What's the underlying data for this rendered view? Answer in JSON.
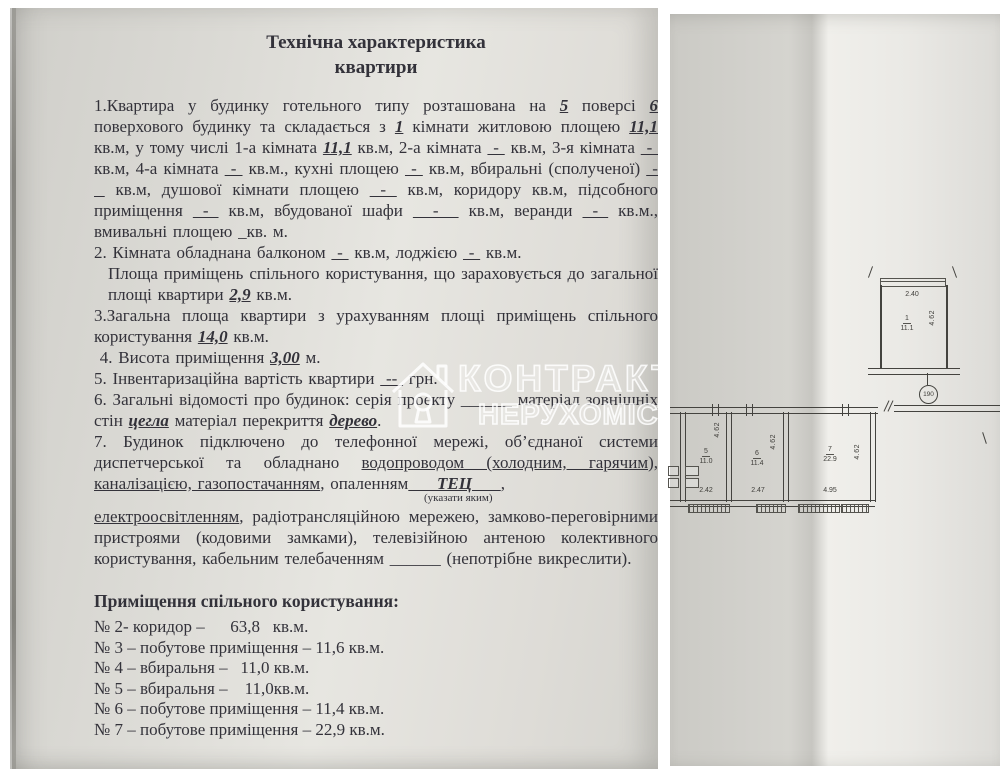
{
  "watermark": {
    "line1": "КОНТРАКТ",
    "line2": "НЕРУХОМІСТЬ",
    "icon": "house-keyhole-icon"
  },
  "document": {
    "title_line1": "Технічна характеристика",
    "title_line2": "квартири",
    "paragraphs": [
      {
        "name": "paragraph-1",
        "segments": [
          {
            "t": "1.Квартира у будинку готельного  типу розташована на "
          },
          {
            "t": "5",
            "s": "fill"
          },
          {
            "t": " поверсі "
          },
          {
            "t": "6",
            "s": "fill"
          },
          {
            "t": " поверхового будинку та складається з "
          },
          {
            "t": "1",
            "s": "fill"
          },
          {
            "t": " кімнати житловою площею "
          },
          {
            "t": "11,1",
            "s": "fill"
          },
          {
            "t": " кв.м, у тому числі 1-а кімната "
          },
          {
            "t": "11,1",
            "s": "fill"
          },
          {
            "t": " кв.м,  2-а кімната "
          },
          {
            "t": " - ",
            "s": "blank"
          },
          {
            "t": " кв.м,  3-я кімната "
          },
          {
            "t": " - ",
            "s": "blank"
          },
          {
            "t": " кв.м, 4-а кімната "
          },
          {
            "t": " - ",
            "s": "blank"
          },
          {
            "t": " кв.м., кухні площею "
          },
          {
            "t": " - ",
            "s": "blank"
          },
          {
            "t": " кв.м, вбиральні (сполученої)  "
          },
          {
            "t": " - ",
            "s": "blank"
          },
          {
            "t": " кв.м, душової кімнати площею "
          },
          {
            "t": " - ",
            "s": "blank"
          },
          {
            "t": " кв.м, коридору кв.м, підсобного приміщення "
          },
          {
            "t": " - ",
            "s": "blank"
          },
          {
            "t": " кв.м, вбудованої шафи "
          },
          {
            "t": "  -  ",
            "s": "blank"
          },
          {
            "t": " кв.м, веранди "
          },
          {
            "t": " - ",
            "s": "blank"
          },
          {
            "t": " кв.м., вмивальні площею _кв. м."
          }
        ]
      },
      {
        "name": "paragraph-2",
        "segments": [
          {
            "t": "2. Кімната обладнана балконом "
          },
          {
            "t": " - ",
            "s": "blank"
          },
          {
            "t": " кв.м, лоджією "
          },
          {
            "t": " - ",
            "s": "blank"
          },
          {
            "t": " кв.м."
          }
        ]
      },
      {
        "name": "paragraph-2b",
        "class": "indent",
        "segments": [
          {
            "t": "Площа приміщень спільного користування, що зараховується до загальної площі квартири "
          },
          {
            "t": "2,9",
            "s": "fill"
          },
          {
            "t": " кв.м."
          }
        ]
      },
      {
        "name": "paragraph-3",
        "segments": [
          {
            "t": "3.Загальна площа квартири з урахуванням площі приміщень спільного користування "
          },
          {
            "t": "14,0",
            "s": "fill"
          },
          {
            "t": " кв.м."
          }
        ]
      },
      {
        "name": "paragraph-4",
        "segments": [
          {
            "t": " 4. Висота приміщення "
          },
          {
            "t": "3,00",
            "s": "fill"
          },
          {
            "t": " м."
          }
        ]
      },
      {
        "name": "paragraph-5",
        "segments": [
          {
            "t": "5. Інвентаризаційна вартість квартири "
          },
          {
            "t": " -- ",
            "s": "blank"
          },
          {
            "t": " грн."
          }
        ]
      },
      {
        "name": "paragraph-6",
        "segments": [
          {
            "t": "6. Загальні відомості про будинок: серія проекту ______ матеріал зовнішніх стін "
          },
          {
            "t": "цегла",
            "s": "fill"
          },
          {
            "t": " матеріал перекриття "
          },
          {
            "t": "дерево",
            "s": "fill"
          },
          {
            "t": "."
          }
        ]
      },
      {
        "name": "paragraph-7",
        "segments": [
          {
            "t": "7. Будинок підключено до телефонної мережі, об’єднаної системи диспетчерської та обладнано "
          },
          {
            "t": "водопроводом (холодним, гарячим), каналізацією, газопостачанням",
            "s": "ul"
          },
          {
            "t": ", опаленням"
          },
          {
            "t": "     ТЕЦ     ",
            "s": "fill"
          },
          {
            "t": ","
          }
        ]
      },
      {
        "name": "paragraph-7-note",
        "class": "note",
        "segments": [
          {
            "t": "(указати яким)"
          }
        ]
      },
      {
        "name": "paragraph-7b",
        "segments": [
          {
            "t": "електроосвітленням",
            "s": "ul"
          },
          {
            "t": ", радіотрансляційною мережею, замково-переговірними пристроями (кодовими замками), телевізійною антеною колективного користування, кабельним телебаченням ______ (непотрібне викреслити)."
          }
        ]
      }
    ],
    "common_header": "Приміщення спільного користування:",
    "common_list": [
      "№ 2- коридор –      63,8   кв.м.",
      "№ 3 – побутове приміщення – 11,6 кв.м.",
      "№ 4 – вбиральня –   11,0 кв.м.",
      "№ 5 – вбиральня –    11,0кв.м.",
      "№ 6 – побутове приміщення – 11,4 кв.м.",
      "№ 7 – побутове приміщення – 22,9 кв.м."
    ]
  },
  "plan": {
    "apartment_circle": "190",
    "upper_room": {
      "number": "1",
      "area": "11.1",
      "width_dim": "2.40",
      "depth_dim": "4.62"
    },
    "rooms": [
      {
        "number": "5",
        "area": "11.0",
        "width_dim": "2.42",
        "depth_dim": "4.62"
      },
      {
        "number": "6",
        "area": "11.4",
        "width_dim": "2.47",
        "depth_dim": "4.62"
      },
      {
        "number": "7",
        "area": "22.9",
        "width_dim": "4.95",
        "depth_dim": "4.62"
      }
    ]
  }
}
